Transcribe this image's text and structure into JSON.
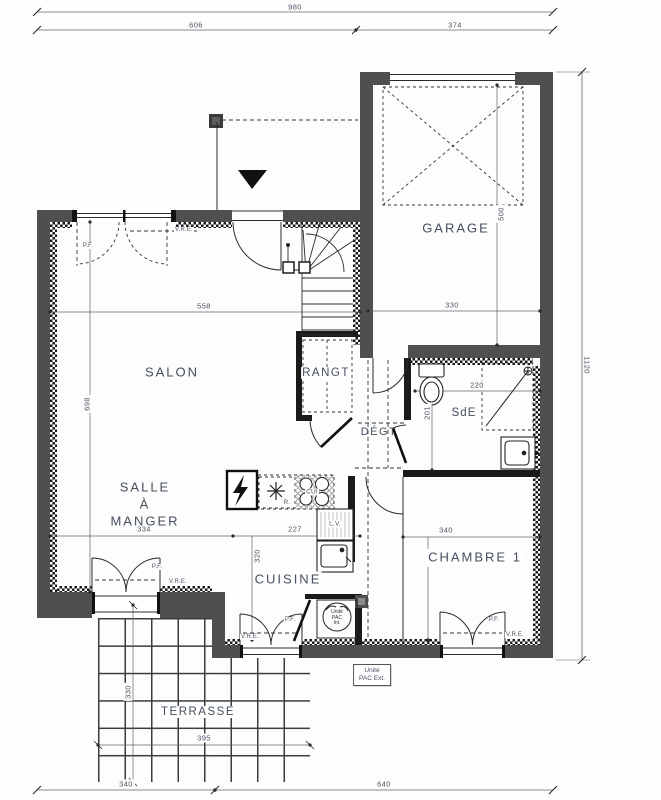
{
  "drawing": {
    "dimensions": {
      "top_total": "980",
      "top_left": "606",
      "top_right": "374",
      "right_height": "1120",
      "garage_depth": "500",
      "garage_width": "330",
      "salon_width": "558",
      "salon_depth": "698",
      "dining_width": "334",
      "kitchen_width": "227",
      "kitchen_depth": "320",
      "sde_width": "220",
      "sde_depth": "201",
      "chambre_width": "340",
      "chambre_depth": "320",
      "terrasse_width": "395",
      "terrasse_depth": "330",
      "bottom_left": "340",
      "bottom_right": "640"
    },
    "rooms": {
      "salon": "SALON",
      "garage": "GARAGE",
      "rangt": "RANGT",
      "degt": "DÉGT",
      "sde": "SdE",
      "dining_l1": "SALLE",
      "dining_l2": "À",
      "dining_l3": "MANGER",
      "cuisine": "CUISINE",
      "chambre": "CHAMBRE 1",
      "terrasse": "TERRASSE"
    },
    "labels": {
      "pf": "P.F.",
      "vre": "V.R.E.",
      "cui": "CUI",
      "lv": "L.V.",
      "fridge": "R.",
      "pac_int_1": "Unité",
      "pac_int_2": "PAC",
      "pac_int_3": "Int.",
      "pac_ext_1": "Unité",
      "pac_ext_2": "PAC Ext."
    }
  }
}
